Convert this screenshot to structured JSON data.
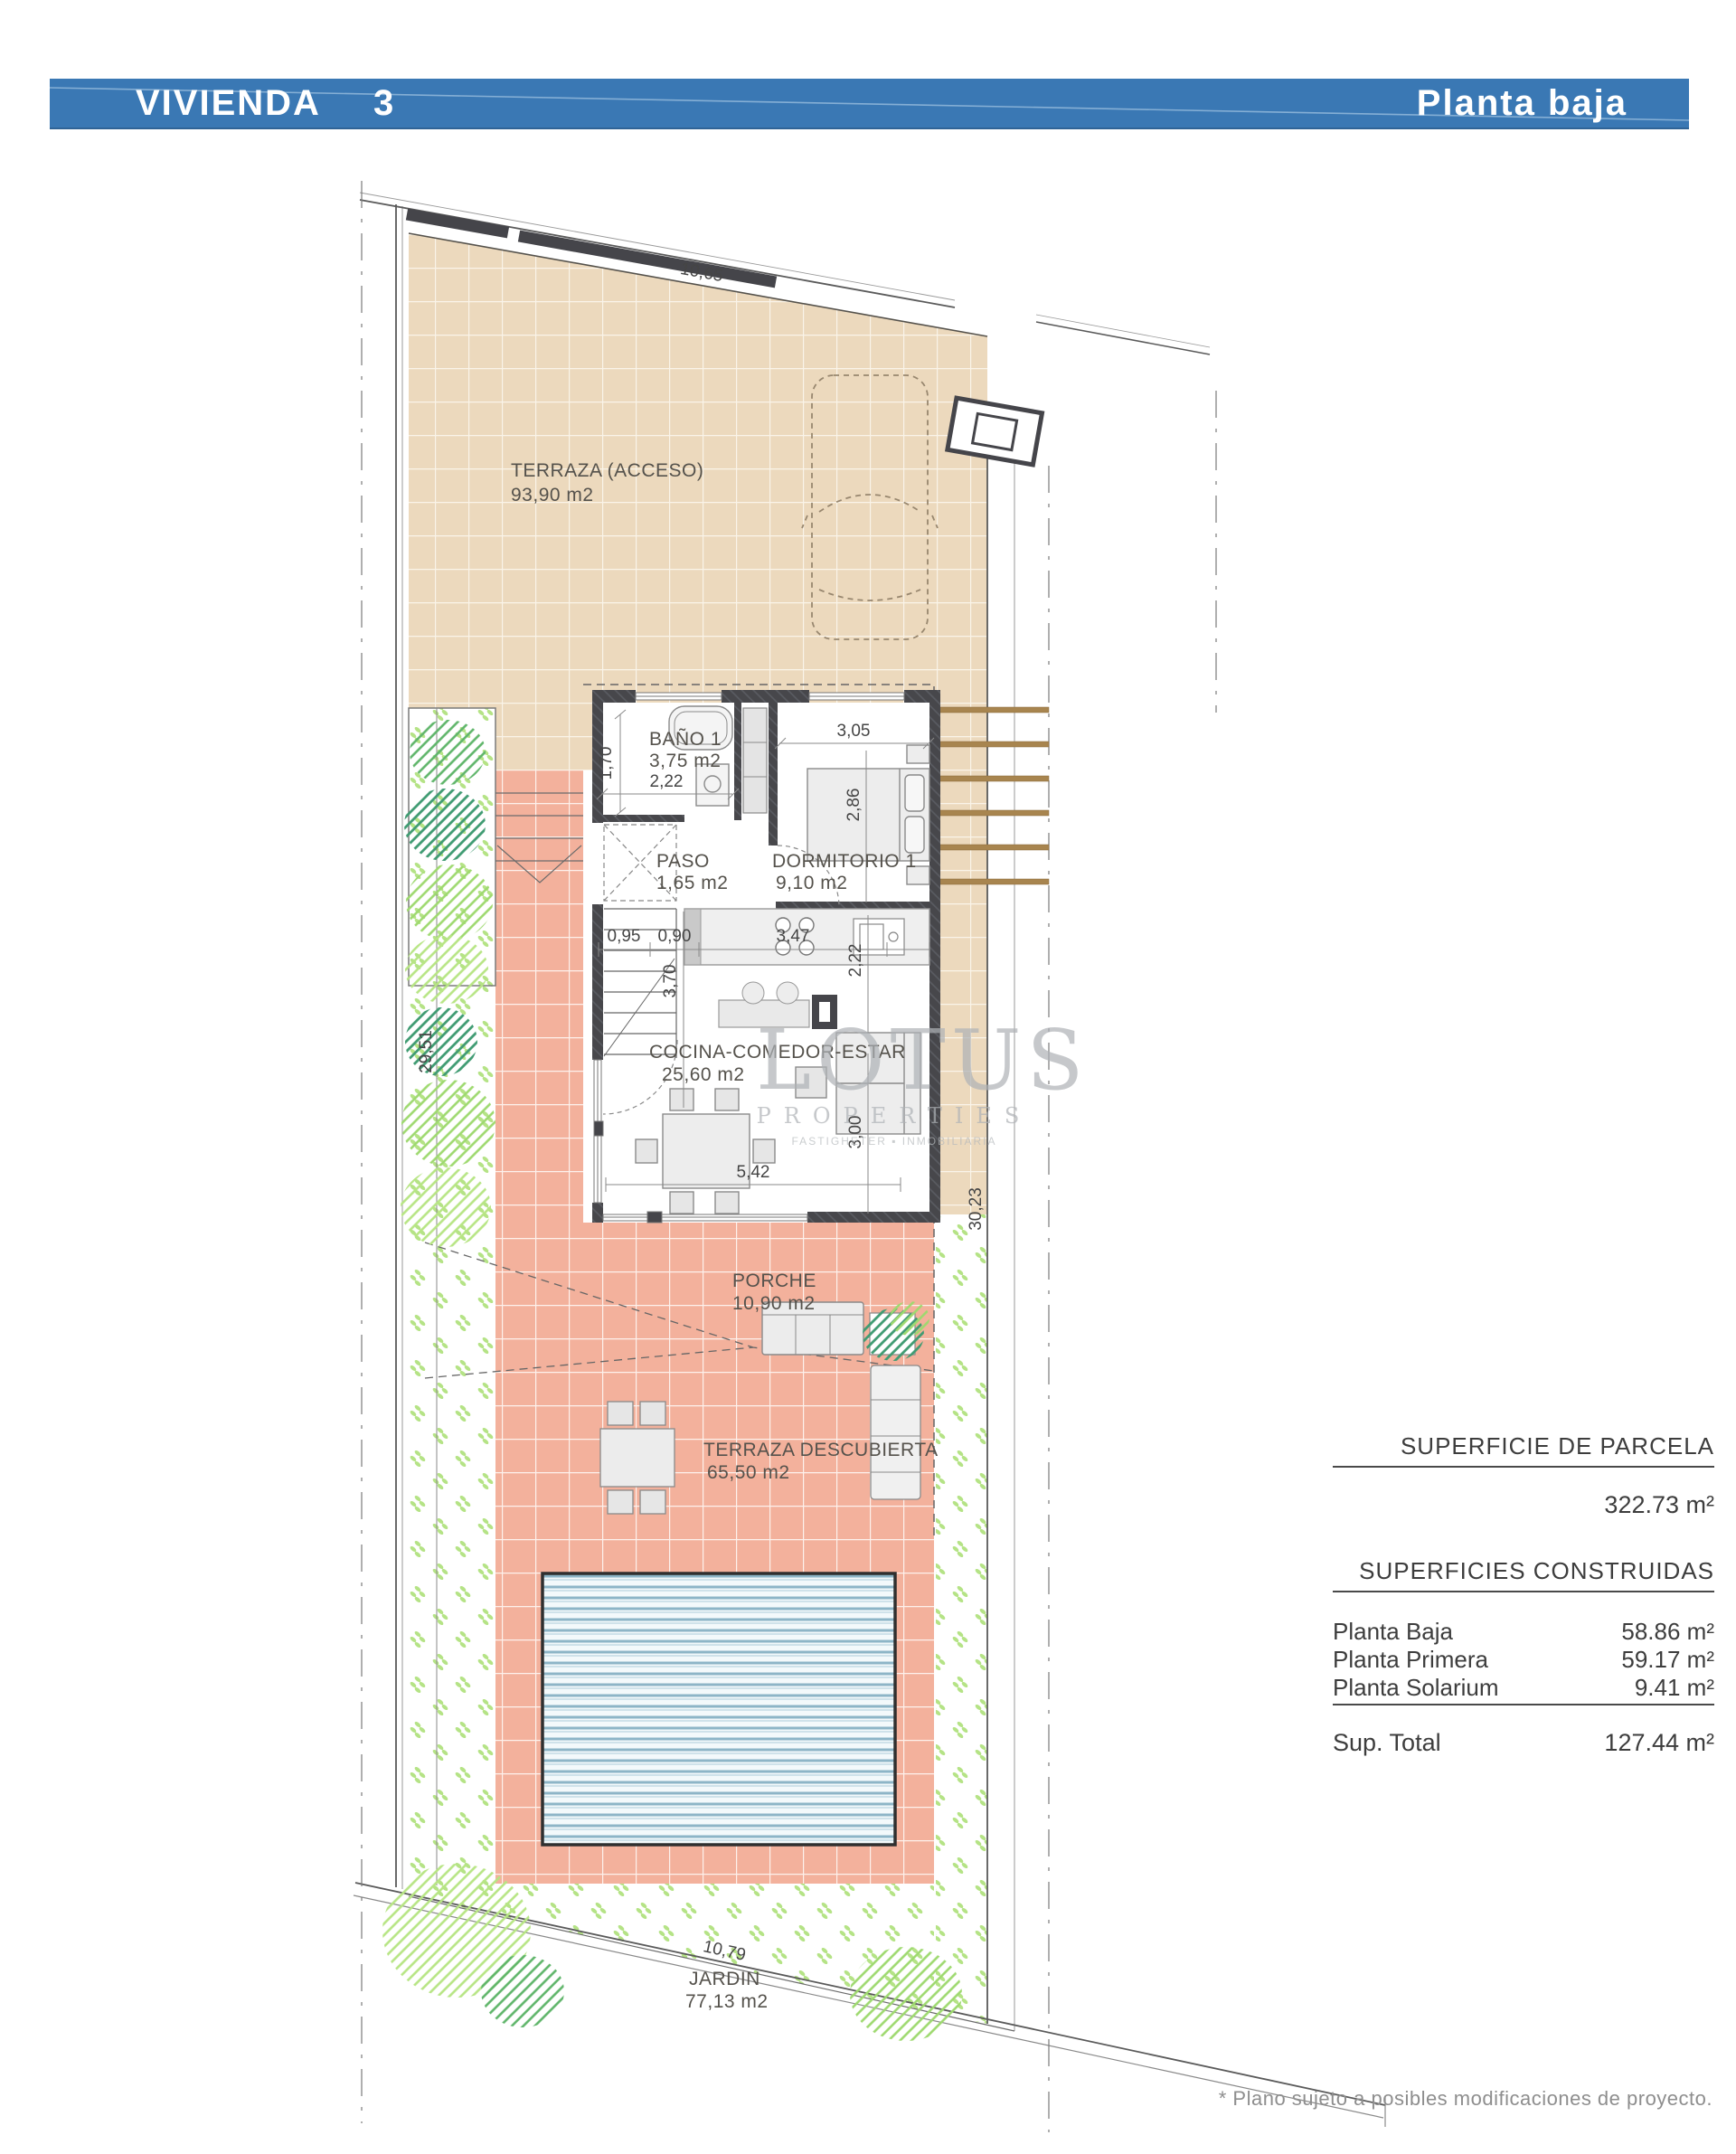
{
  "header": {
    "title_left": "VIVIENDA",
    "title_left_num": "3",
    "title_right": "Planta baja"
  },
  "plan": {
    "rooms": {
      "terraza": {
        "name": "TERRAZA (ACCESO)",
        "area": "93,90 m2"
      },
      "bano": {
        "name": "BAÑO 1",
        "area": "3,75 m2"
      },
      "paso": {
        "name": "PASO",
        "area": "1,65 m2"
      },
      "dormitorio": {
        "name": "DORMITORIO 1",
        "area": "9,10 m2"
      },
      "cocina": {
        "name": "COCINA-COMEDOR-ESTAR",
        "area": "25,60 m2"
      },
      "porche": {
        "name": "PORCHE",
        "area": "10,90 m2"
      },
      "terraza_descubierta": {
        "name": "TERRAZA DESCUBIERTA",
        "area": "65,50 m2"
      },
      "jardin": {
        "name": "JARDIN",
        "area": "77,13 m2"
      }
    },
    "dims": {
      "top_width": "10,65",
      "bano_width": "1,70",
      "bano_depth": "2,22",
      "dorm_width": "3,05",
      "dorm_depth": "2,86",
      "stair_width": "0,95",
      "pass_width": "0,90",
      "kitchen_width": "3,47",
      "kitchen_depth": "2,22",
      "stair_length": "3,70",
      "living_width": "5,42",
      "living_depth": "3,00",
      "plot_left": "29,51",
      "plot_right": "30,23",
      "plot_bottom": "10,79"
    }
  },
  "watermark": {
    "line1": "LOTUS",
    "line2": "PROPERTIES",
    "line3": "FASTIGHETER ▪ INMOBILIARIA"
  },
  "panel": {
    "parcela_title": "SUPERFICIE DE PARCELA",
    "parcela_value": "322.73 m²",
    "construidas_title": "SUPERFICIES CONSTRUIDAS",
    "rows": [
      {
        "label": "Planta Baja",
        "value": "58.86 m²"
      },
      {
        "label": "Planta Primera",
        "value": "59.17 m²"
      },
      {
        "label": "Planta Solarium",
        "value": "9.41 m²"
      }
    ],
    "total_label": "Sup. Total",
    "total_value": "127.44 m²"
  },
  "footnote": "* Plano sujeto a posibles modificaciones de proyecto.",
  "colors": {
    "header_blue": "#3a78b4",
    "tile_beige": "#ecd9bd",
    "tile_pink": "#f3b19c",
    "grass_green": "#b5e386",
    "pool_blue": "#8db5c7",
    "wall_dark": "#47474b"
  }
}
